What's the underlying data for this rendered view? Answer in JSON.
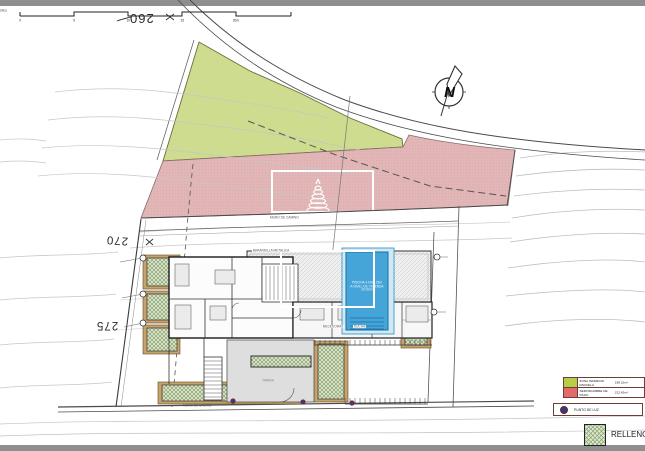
{
  "drawing": {
    "type": "site-plan",
    "scale_bar": {
      "label": "Escala Gráfica",
      "ticks": [
        "0",
        "5",
        "10",
        "15",
        "20m"
      ]
    },
    "north_arrow": {
      "label": "N"
    },
    "contour_labels": {
      "c260": "260",
      "c270": "270",
      "c275": "275"
    },
    "annotations": {
      "muro_top": "MURO DE CAMINO",
      "muro_bottom": "MURO DE CAMINO",
      "barandilla": "BARANDILLA METALICA",
      "mecedoras": "MECEDORAS",
      "ducha": "DUCHA",
      "tarima": "TARIMA"
    },
    "pool": {
      "line1": "PISCINA 4.00x7.25m",
      "line2": "A NIVEL DE VIVIENDA",
      "line3": "29.00m²"
    }
  },
  "legend": {
    "zones": [
      {
        "label": "ZONA INFERIOR PARCELA.",
        "value": "198.15m²",
        "color": "#b9cc45"
      },
      {
        "label": "SERVIDUMBRE DE PASO.",
        "value": "222.42m²",
        "color": "#e4696b"
      }
    ],
    "punto_de_luz": "PUNTO DE LUZ",
    "relleno": "RELLENO"
  },
  "colors": {
    "green_zone": "#cddc8e",
    "servidumbre_zone": "#e2b6b6",
    "pool_water": "#45a5d8",
    "relleno_fill": "#dfe8cf",
    "relleno_hatch": "#8aa273",
    "planter_frame": "#c9a269",
    "frame_strip": "#8f8f8f",
    "punto_dot": "#2b3f87"
  }
}
